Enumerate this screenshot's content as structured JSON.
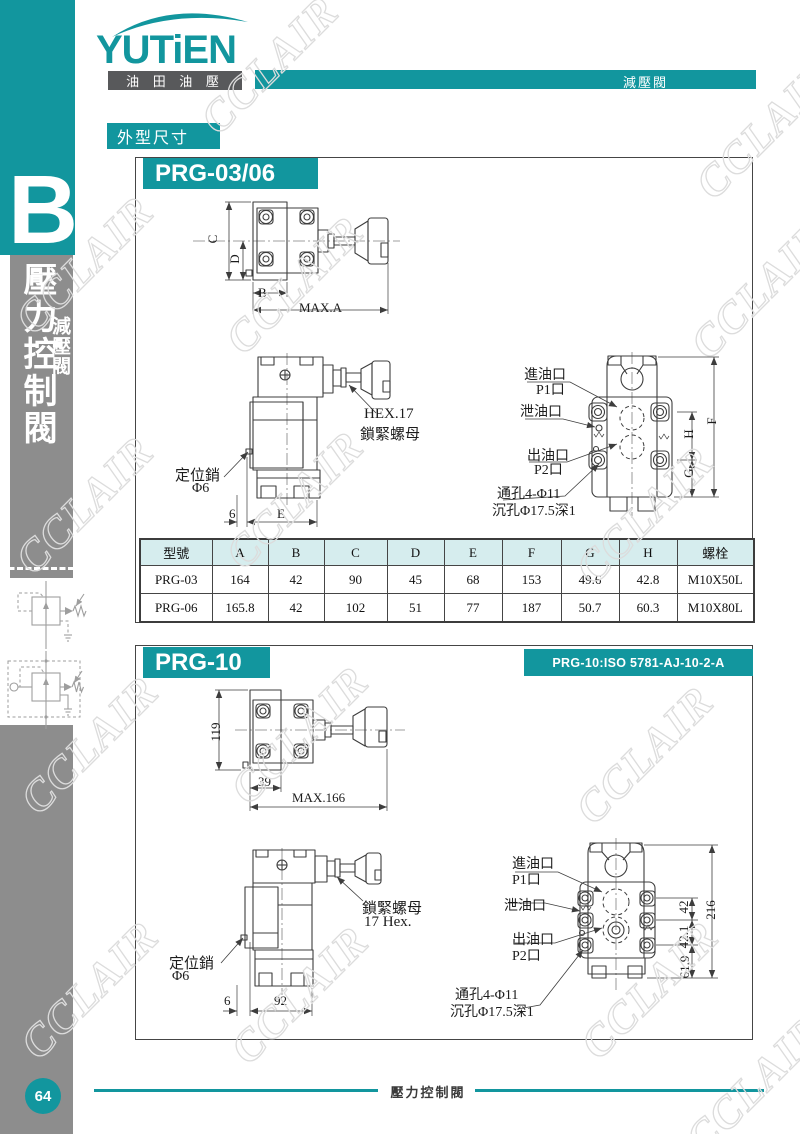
{
  "theme": {
    "teal": "#12969e",
    "dark": "#58595b",
    "gray": "#8d8d8d",
    "thead": "#d6edee"
  },
  "watermark": {
    "text": "CCLAIR"
  },
  "brand": {
    "logo": "YUTiEN",
    "logo_sub": "油 田 油 壓"
  },
  "header": {
    "tab": "減壓閥",
    "section": "外型尺寸"
  },
  "sidebar": {
    "letter": "B",
    "title": "壓力控制閥",
    "subtitle": "減壓閥",
    "page_num": "64"
  },
  "footer": {
    "label": "壓力控制閥"
  },
  "prg0306": {
    "title": "PRG-03/06",
    "top": {
      "c": "C",
      "d": "D",
      "b": "B",
      "maxa": "MAX.A"
    },
    "side": {
      "hex": "HEX.17",
      "nut": "鎖緊螺母",
      "pin": "定位銷",
      "pin_d": "Φ6",
      "d6": "6",
      "e": "E"
    },
    "bottom": {
      "inlet": "進油口",
      "p1": "P1口",
      "drain": "泄油口",
      "outlet": "出油口",
      "p2": "P2口",
      "holes": "通孔4-Φ11",
      "cbore": "沉孔Φ17.5深1",
      "h": "H",
      "g": "G",
      "f": "F"
    },
    "table": {
      "headers": [
        "型號",
        "A",
        "B",
        "C",
        "D",
        "E",
        "F",
        "G",
        "H",
        "螺栓"
      ],
      "rows": [
        [
          "PRG-03",
          "164",
          "42",
          "90",
          "45",
          "68",
          "153",
          "49.6",
          "42.8",
          "M10X50L"
        ],
        [
          "PRG-06",
          "165.8",
          "42",
          "102",
          "51",
          "77",
          "187",
          "50.7",
          "60.3",
          "M10X80L"
        ]
      ]
    }
  },
  "prg10": {
    "title": "PRG-10",
    "iso": "PRG-10:ISO 5781-AJ-10-2-A",
    "top": {
      "d119": "119",
      "d39": "39",
      "max": "MAX.166"
    },
    "side": {
      "nut": "鎖緊螺母",
      "hex": "17 Hex.",
      "pin": "定位銷",
      "pin_d": "Φ6",
      "d6": "6",
      "d92": "92"
    },
    "bottom": {
      "inlet": "進油口",
      "p1": "P1口",
      "drain": "泄油口",
      "outlet": "出油口",
      "p2": "P2口",
      "holes": "通孔4-Φ11",
      "cbore": "沉孔Φ17.5深1",
      "d42": "42",
      "d421": "42.1",
      "d619": "61.9",
      "d216": "216"
    }
  }
}
